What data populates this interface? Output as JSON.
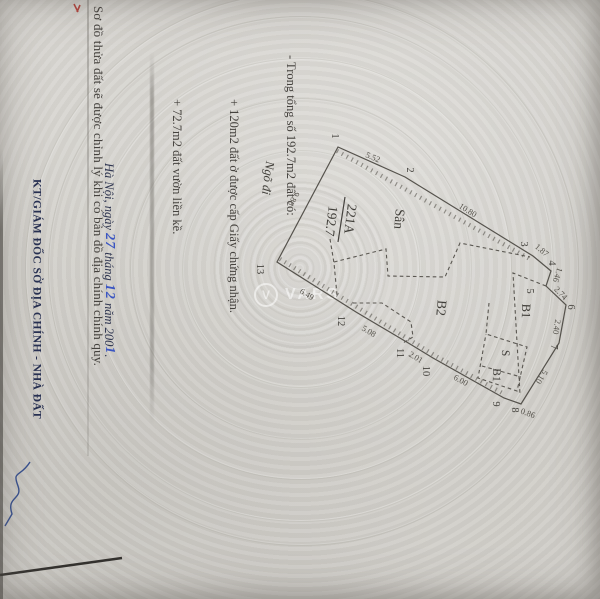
{
  "notes": {
    "line1": "- Trong tổng số 192.7m2 đất có:",
    "line2": "+ 120m2 đất ở được cấp Giấy chứng nhận.",
    "line3": "+ 72.7m2 đất vườn liền kề."
  },
  "footer_note": "Sơ đồ thửa đất sẽ được chỉnh lý khi có bản đồ địa chính chính quy.",
  "signature": {
    "place_prefix": "Hà Nội, ngày ",
    "day_handwritten": "27",
    "month_label": " tháng ",
    "month_handwritten": "12",
    "year_label": " năm 200",
    "year_handwritten": "1",
    "period": ".",
    "title": "KT/GIÁM ĐỐC SỞ ĐỊA CHÍNH - NHÀ ĐẤT"
  },
  "watermark": {
    "logo_letter": "V",
    "text": "VARS"
  },
  "diagram": {
    "parcel": {
      "num": "221A",
      "den": "192.7"
    },
    "regions": {
      "san": "Sân",
      "b2": "B2",
      "b1": "B1",
      "s2": "S",
      "b1b": "B1",
      "alley": "Ngõ đi"
    },
    "v": {
      "v1": "1",
      "v2": "2",
      "v3": "3",
      "v4": "4",
      "v5": "5",
      "v6": "6",
      "v7": "7",
      "v8": "8",
      "v9": "9",
      "v10": "10",
      "v11": "11",
      "v12": "12",
      "v13": "13"
    },
    "e": {
      "e12": "5.52",
      "e23": "10.80",
      "e34": "1.87",
      "e45": "1.46",
      "e56": "2.74",
      "e67": "2.40",
      "e78": "5.10",
      "e89": "0.86",
      "e910": "6.00",
      "e1011": "2.01",
      "e1112": "5.08",
      "e1213": "6.49",
      "e131": "9.88"
    }
  },
  "colors": {
    "paper": "#d5d3ce",
    "ink": "#45423e",
    "navy_print": "#2e3550",
    "handwriting_blue": "#3a55c2",
    "red_mark": "#b5433c",
    "boundary": "#55524c"
  }
}
